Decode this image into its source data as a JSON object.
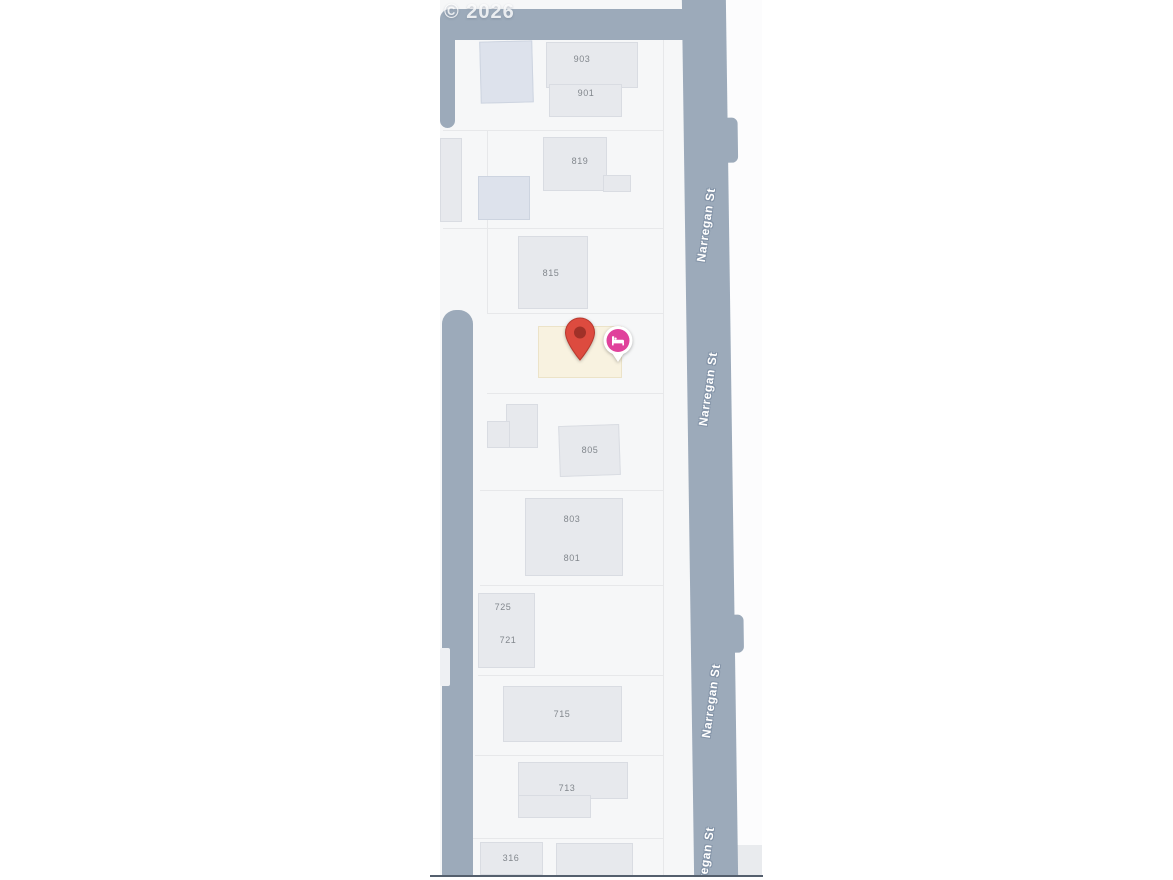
{
  "map": {
    "copyright": "© 2026",
    "street_name": "Narregan St",
    "street_labels": [
      {
        "text": "Narregan St",
        "x": 266,
        "y": 225,
        "rot": -82
      },
      {
        "text": "Narregan St",
        "x": 268,
        "y": 389,
        "rot": -82
      },
      {
        "text": "Narregan St",
        "x": 271,
        "y": 701,
        "rot": -82
      },
      {
        "text": "Narregan St",
        "x": 265,
        "y": 864,
        "rot": -82
      }
    ],
    "address_labels": [
      {
        "text": "903",
        "x": 142,
        "y": 59
      },
      {
        "text": "901",
        "x": 146,
        "y": 93
      },
      {
        "text": "819",
        "x": 140,
        "y": 161
      },
      {
        "text": "815",
        "x": 111,
        "y": 273
      },
      {
        "text": "805",
        "x": 150,
        "y": 450
      },
      {
        "text": "803",
        "x": 132,
        "y": 519
      },
      {
        "text": "801",
        "x": 132,
        "y": 558
      },
      {
        "text": "725",
        "x": 63,
        "y": 607
      },
      {
        "text": "721",
        "x": 68,
        "y": 640
      },
      {
        "text": "715",
        "x": 122,
        "y": 714
      },
      {
        "text": "713",
        "x": 127,
        "y": 788
      },
      {
        "text": "316",
        "x": 71,
        "y": 858
      }
    ],
    "buildings": [
      {
        "x": 40,
        "y": 41,
        "w": 53,
        "h": 62,
        "tint": "blue",
        "rot": -1.5
      },
      {
        "x": 106,
        "y": 42,
        "w": 92,
        "h": 46
      },
      {
        "x": 109,
        "y": 84,
        "w": 73,
        "h": 33
      },
      {
        "x": 103,
        "y": 137,
        "w": 64,
        "h": 54
      },
      {
        "x": 163,
        "y": 175,
        "w": 28,
        "h": 17
      },
      {
        "x": 38,
        "y": 176,
        "w": 52,
        "h": 44,
        "tint": "blue"
      },
      {
        "x": 0,
        "y": 138,
        "w": 22,
        "h": 84
      },
      {
        "x": 78,
        "y": 236,
        "w": 70,
        "h": 73
      },
      {
        "x": 119,
        "y": 425,
        "w": 61,
        "h": 51,
        "rot": -2
      },
      {
        "x": 66,
        "y": 404,
        "w": 32,
        "h": 44
      },
      {
        "x": 47,
        "y": 421,
        "w": 23,
        "h": 27
      },
      {
        "x": 85,
        "y": 498,
        "w": 98,
        "h": 78
      },
      {
        "x": 38,
        "y": 593,
        "w": 57,
        "h": 75
      },
      {
        "x": 63,
        "y": 686,
        "w": 119,
        "h": 56
      },
      {
        "x": 78,
        "y": 762,
        "w": 110,
        "h": 37
      },
      {
        "x": 78,
        "y": 795,
        "w": 73,
        "h": 23
      },
      {
        "x": 40,
        "y": 842,
        "w": 63,
        "h": 33
      },
      {
        "x": 116,
        "y": 843,
        "w": 77,
        "h": 34
      }
    ],
    "highlighted_parcel": {
      "x": 98,
      "y": 326,
      "w": 84,
      "h": 52
    },
    "parcel_lines": {
      "horizontal": [
        {
          "x": 3,
          "y": 130,
          "w": 220
        },
        {
          "x": 3,
          "y": 228,
          "w": 220
        },
        {
          "x": 47,
          "y": 313,
          "w": 176
        },
        {
          "x": 47,
          "y": 393,
          "w": 176
        },
        {
          "x": 40,
          "y": 490,
          "w": 183
        },
        {
          "x": 40,
          "y": 585,
          "w": 183
        },
        {
          "x": 38,
          "y": 675,
          "w": 185
        },
        {
          "x": 35,
          "y": 755,
          "w": 188
        },
        {
          "x": 33,
          "y": 838,
          "w": 190
        }
      ],
      "vertical": [
        {
          "x": 223,
          "y": 40,
          "h": 835
        },
        {
          "x": 47,
          "y": 130,
          "h": 183
        }
      ]
    },
    "markers": {
      "location_pin": {
        "type": "red-location-pin"
      },
      "lodging": {
        "type": "lodging-poi"
      }
    }
  },
  "colors": {
    "road": "#9caaba",
    "parcel_bg": "#f6f7f8",
    "parcel_line": "#e7e8ea",
    "building": "#e7e9ed",
    "building_border": "#d9dce2",
    "building_blue": "#dde2ec",
    "poi_fill": "#f8f2e0",
    "poi_border": "#ece3c8",
    "addr_label": "#82878d",
    "street_text": "#ffffff",
    "street_halo": "#8494a8",
    "pin_body": "#dd4b3f",
    "pin_stroke": "#b9382e",
    "pin_inner": "#a03128",
    "lodging_pink": "#e0419b",
    "bottom_line": "#545f6d"
  }
}
